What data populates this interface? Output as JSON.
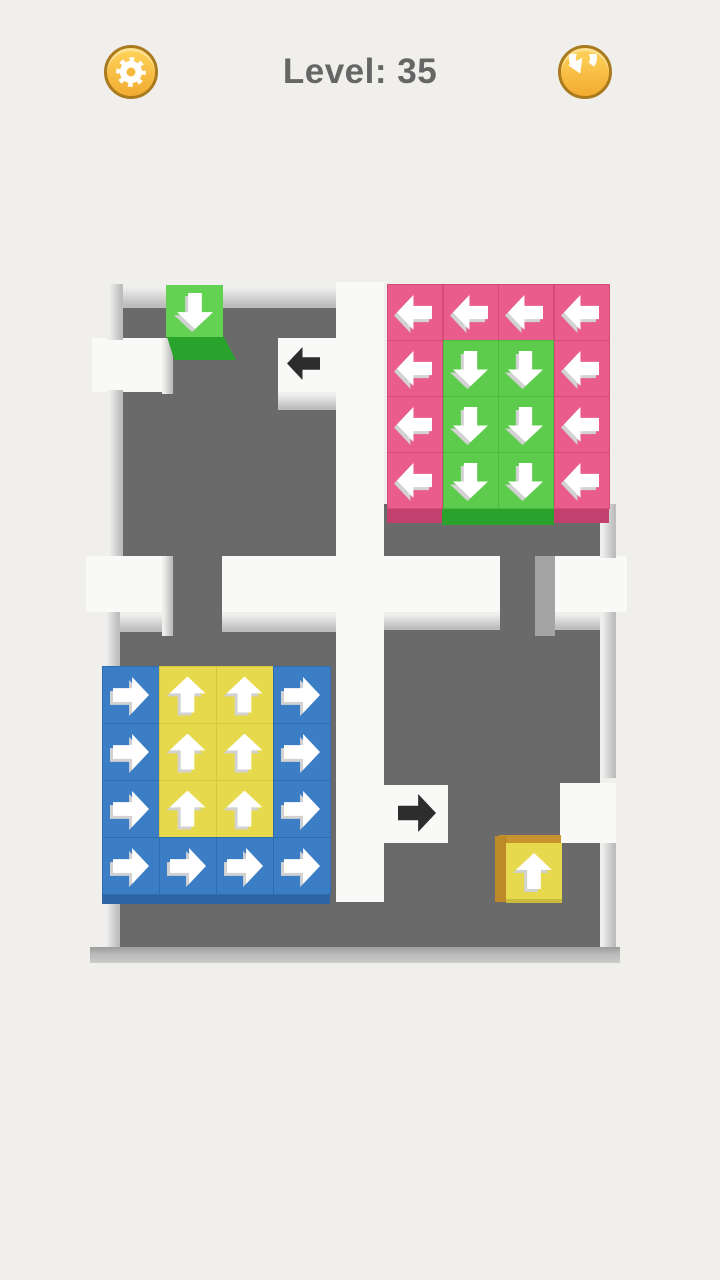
{
  "header": {
    "title": "Level: 35",
    "settings_icon": "gear-icon",
    "restart_icon": "restart-icon"
  },
  "colors": {
    "page_bg": "#f1efec",
    "gap": "#f9f9f8",
    "floor": "#6a6a6a",
    "arrow_white": "#ffffff",
    "arrow_shadow": "#d2d2d2",
    "floor_arrow": "#2d2d2d",
    "title": "#666666"
  },
  "board": {
    "floors": [
      {
        "x": 123,
        "y": 306,
        "w": 213,
        "h": 34
      },
      {
        "x": 173,
        "y": 338,
        "w": 105,
        "h": 56
      },
      {
        "x": 123,
        "y": 392,
        "w": 213,
        "h": 164
      },
      {
        "x": 173,
        "y": 556,
        "w": 49,
        "h": 80
      },
      {
        "x": 120,
        "y": 632,
        "w": 216,
        "h": 315
      },
      {
        "x": 336,
        "y": 902,
        "w": 48,
        "h": 45
      },
      {
        "x": 384,
        "y": 504,
        "w": 216,
        "h": 54
      },
      {
        "x": 500,
        "y": 556,
        "w": 35,
        "h": 80
      },
      {
        "x": 384,
        "y": 630,
        "w": 216,
        "h": 317
      }
    ],
    "gaps": [
      {
        "x": 336,
        "y": 282,
        "w": 48,
        "h": 620
      },
      {
        "x": 92,
        "y": 338,
        "w": 70,
        "h": 54
      },
      {
        "x": 278,
        "y": 338,
        "w": 58,
        "h": 54
      },
      {
        "x": 86,
        "y": 556,
        "w": 76,
        "h": 56
      },
      {
        "x": 222,
        "y": 556,
        "w": 114,
        "h": 56
      },
      {
        "x": 384,
        "y": 556,
        "w": 116,
        "h": 56
      },
      {
        "x": 555,
        "y": 556,
        "w": 72,
        "h": 56
      },
      {
        "x": 384,
        "y": 785,
        "w": 64,
        "h": 58
      },
      {
        "x": 560,
        "y": 783,
        "w": 56,
        "h": 60
      }
    ],
    "walls": [
      {
        "x": 107,
        "y": 284,
        "w": 229,
        "h": 24,
        "g": "v"
      },
      {
        "x": 107,
        "y": 284,
        "w": 16,
        "h": 56,
        "g": "h"
      },
      {
        "x": 107,
        "y": 390,
        "w": 16,
        "h": 166,
        "g": "h"
      },
      {
        "x": 162,
        "y": 338,
        "w": 11,
        "h": 56,
        "g": "h"
      },
      {
        "x": 278,
        "y": 392,
        "w": 58,
        "h": 18,
        "g": "v"
      },
      {
        "x": 162,
        "y": 556,
        "w": 11,
        "h": 80,
        "g": "h"
      },
      {
        "x": 222,
        "y": 612,
        "w": 114,
        "h": 20,
        "g": "v"
      },
      {
        "x": 104,
        "y": 612,
        "w": 58,
        "h": 20,
        "g": "v"
      },
      {
        "x": 104,
        "y": 612,
        "w": 16,
        "h": 335,
        "g": "h"
      },
      {
        "x": 600,
        "y": 504,
        "w": 16,
        "h": 54,
        "g": "h"
      },
      {
        "x": 535,
        "y": 556,
        "w": 20,
        "h": 80,
        "flat": "#a4a4a4"
      },
      {
        "x": 555,
        "y": 612,
        "w": 45,
        "h": 18,
        "g": "v"
      },
      {
        "x": 384,
        "y": 612,
        "w": 116,
        "h": 18,
        "g": "v"
      },
      {
        "x": 600,
        "y": 612,
        "w": 16,
        "h": 166,
        "g": "h"
      },
      {
        "x": 600,
        "y": 843,
        "w": 16,
        "h": 104,
        "g": "h"
      },
      {
        "x": 90,
        "y": 947,
        "w": 530,
        "h": 16,
        "g": "bottom"
      }
    ],
    "strips": [
      {
        "x": 387,
        "y": 508,
        "w": 55,
        "h": 15,
        "color": "#c33f6e"
      },
      {
        "x": 442,
        "y": 508,
        "w": 112,
        "h": 17,
        "color": "#2aa22c"
      },
      {
        "x": 554,
        "y": 508,
        "w": 55,
        "h": 15,
        "color": "#c33f6e"
      },
      {
        "x": 102,
        "y": 894,
        "w": 228,
        "h": 10,
        "color": "#2d64a6"
      }
    ],
    "grids": [
      {
        "name": "pink-green-grid",
        "x": 387,
        "y": 284,
        "cw": 55.5,
        "ch": 56,
        "arrow_size": 35,
        "types": {
          "P": {
            "name": "pink-left",
            "color": "#e95c8b",
            "border": "#d64a7a",
            "dir": "left"
          },
          "G": {
            "name": "green-down",
            "color": "#5dcc4c",
            "border": "#4abc3b",
            "dir": "down"
          }
        },
        "rows": [
          "PPPP",
          "PGGP",
          "PGGP",
          "PGGP"
        ]
      },
      {
        "name": "blue-yellow-grid",
        "x": 102,
        "y": 666,
        "cw": 57,
        "ch": 57,
        "arrow_size": 36,
        "types": {
          "B": {
            "name": "blue-right",
            "color": "#3b7ec6",
            "border": "#2f6db3",
            "dir": "right"
          },
          "Y": {
            "name": "yellow-up",
            "color": "#e6d94b",
            "border": "#d5c73e",
            "dir": "up"
          }
        },
        "rows": [
          "BYYB",
          "BYYB",
          "BYYB",
          "BBBB"
        ]
      }
    ],
    "cubes": [
      {
        "name": "arrow-block-green-down",
        "parts": [
          {
            "x": 166,
            "y": 336,
            "w": 70,
            "h": 24,
            "color": "#2aa32c",
            "clip": "polygon(1% 0%, 82% 0%, 100% 100%, 12% 100%)"
          }
        ],
        "face": {
          "x": 166,
          "y": 285,
          "w": 57,
          "h": 52,
          "color": "#63d252"
        },
        "arrow": {
          "dir": "down",
          "s": 36
        }
      },
      {
        "name": "arrow-block-yellow-up",
        "parts": [
          {
            "x": 499,
            "y": 835,
            "w": 62,
            "h": 10,
            "color": "#c9942e"
          },
          {
            "x": 495,
            "y": 836,
            "w": 12,
            "h": 66,
            "color": "#bd8929"
          },
          {
            "x": 506,
            "y": 897,
            "w": 56,
            "h": 6,
            "color": "#cabb3c"
          }
        ],
        "face": {
          "x": 506,
          "y": 843,
          "w": 56,
          "h": 56,
          "color": "#e7d94d"
        },
        "arrow": {
          "dir": "up",
          "s": 36
        }
      }
    ],
    "floor_arrows": [
      {
        "dir": "left",
        "x": 287,
        "y": 347,
        "s": 33
      },
      {
        "dir": "right",
        "x": 398,
        "y": 794,
        "s": 38
      }
    ]
  }
}
